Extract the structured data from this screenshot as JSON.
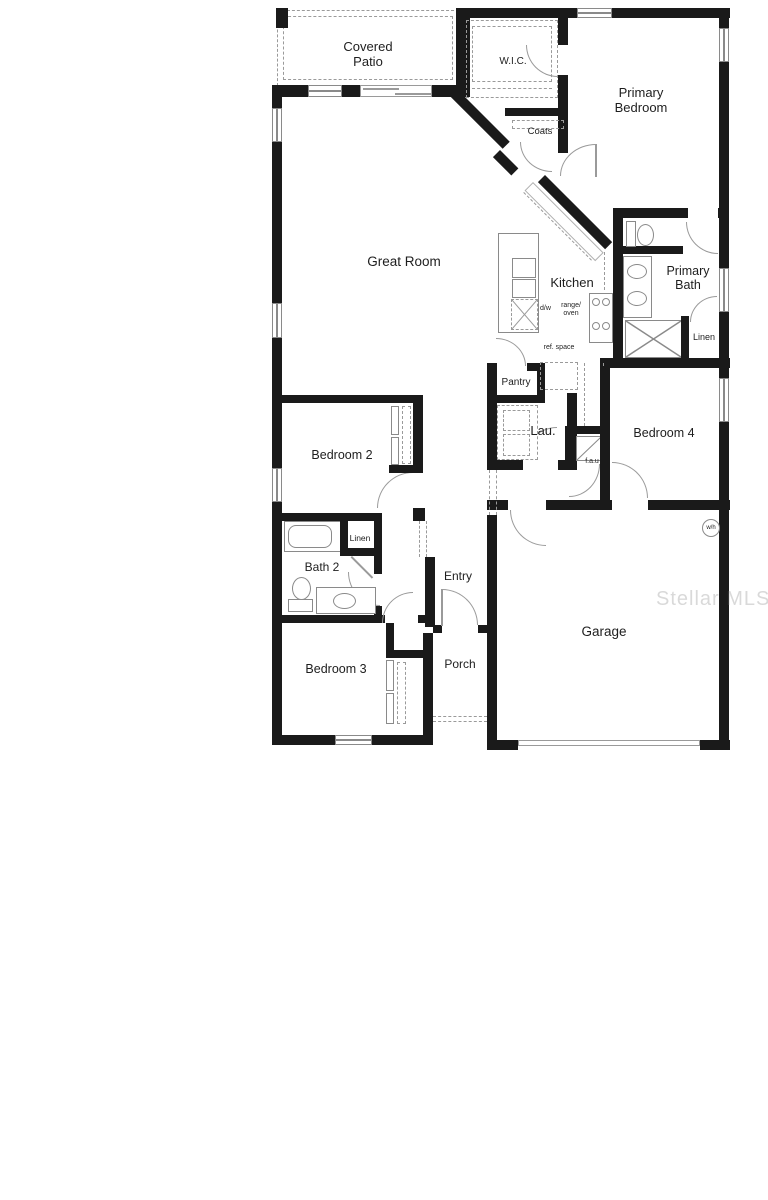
{
  "rooms": {
    "covered_patio": "Covered Patio",
    "wic": "W.I.C.",
    "primary_bedroom": "Primary Bedroom",
    "coats": "Coats",
    "great_room": "Great Room",
    "kitchen": "Kitchen",
    "primary_bath": "Primary Bath",
    "linen_primary": "Linen",
    "pantry": "Pantry",
    "ref_space": "ref. space",
    "laundry": "Lau.",
    "fau": "f.a.u",
    "bedroom_4": "Bedroom 4",
    "bedroom_2": "Bedroom 2",
    "linen_hall": "Linen",
    "bath_2": "Bath 2",
    "entry": "Entry",
    "bedroom_3": "Bedroom 3",
    "porch": "Porch",
    "garage": "Garage"
  },
  "fixtures": {
    "dishwasher": "d/w",
    "range_oven": "range/ oven",
    "water_heater": "w/h"
  },
  "watermark": "Stellar MLS",
  "colors": {
    "wall": "#1a1a1a",
    "line": "#8a8a8a",
    "watermark_gray": "#bdbdbd"
  }
}
